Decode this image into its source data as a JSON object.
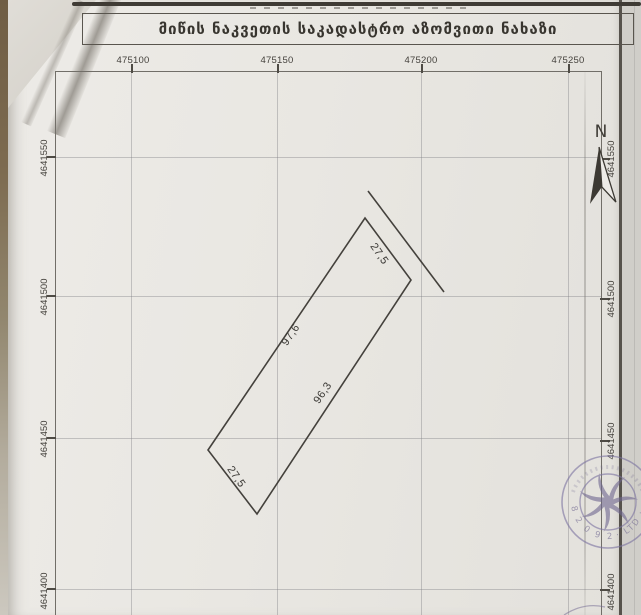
{
  "document": {
    "title": "მიწის ნაკვეთის საკადასტრო აზომვითი ნახაზი"
  },
  "grid": {
    "top_labels": [
      "475100",
      "475150",
      "475200",
      "475250"
    ],
    "left_labels": [
      "4641550",
      "4641500",
      "4641450",
      "4641400"
    ],
    "right_labels": [
      "4641550",
      "4641500",
      "4641450",
      "4641400"
    ]
  },
  "parcel": {
    "dimensions": {
      "top": "27,5",
      "left": "97,6",
      "right": "96,3",
      "bottom": "27,5"
    }
  },
  "compass": {
    "north_label": "N"
  },
  "stamp": {
    "arc_digits": "8 2 0 9 2",
    "arc_suffix": "· LTD ·"
  },
  "colors": {
    "paper": "#eae8e3",
    "ink": "#44413c",
    "stamp_tint": "#7b72a0"
  }
}
